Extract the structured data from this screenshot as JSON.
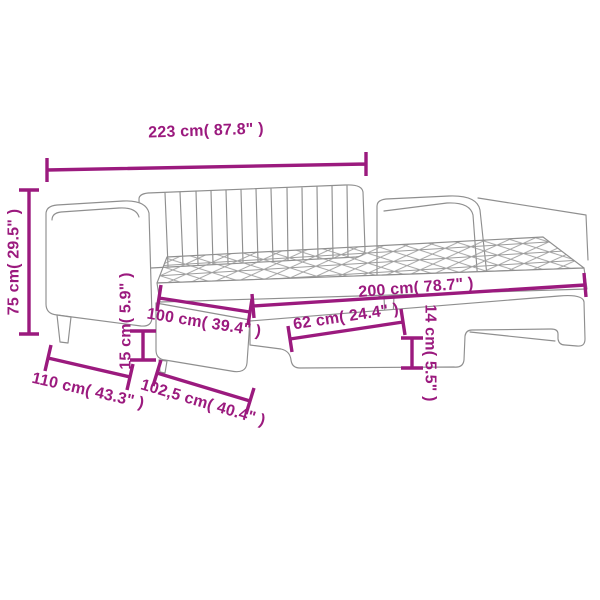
{
  "diagram": {
    "type": "product-dimension-diagram",
    "subject": "daybed-with-pullout-trundle",
    "colors": {
      "dimension": "#9b1a7e",
      "line_art": "#8f8f8f",
      "background": "#ffffff"
    },
    "dimensions": [
      {
        "id": "overall-length",
        "label": "223 cm( 87.8\" )"
      },
      {
        "id": "overall-height",
        "label": "75 cm( 29.5\" )"
      },
      {
        "id": "bed-width",
        "label": "100 cm( 39.4\" )"
      },
      {
        "id": "underbed-clearance-length",
        "label": "62 cm( 24.4\" )"
      },
      {
        "id": "sleeping-length",
        "label": "200 cm( 78.7\" )"
      },
      {
        "id": "floor-clearance-left",
        "label": "15 cm( 5.9\" )"
      },
      {
        "id": "frame-depth",
        "label": "110 cm( 43.3\" )"
      },
      {
        "id": "trundle-width",
        "label": "102,5 cm( 40.4\" )"
      },
      {
        "id": "floor-clearance-right",
        "label": "14 cm( 5.5\" )"
      }
    ]
  }
}
